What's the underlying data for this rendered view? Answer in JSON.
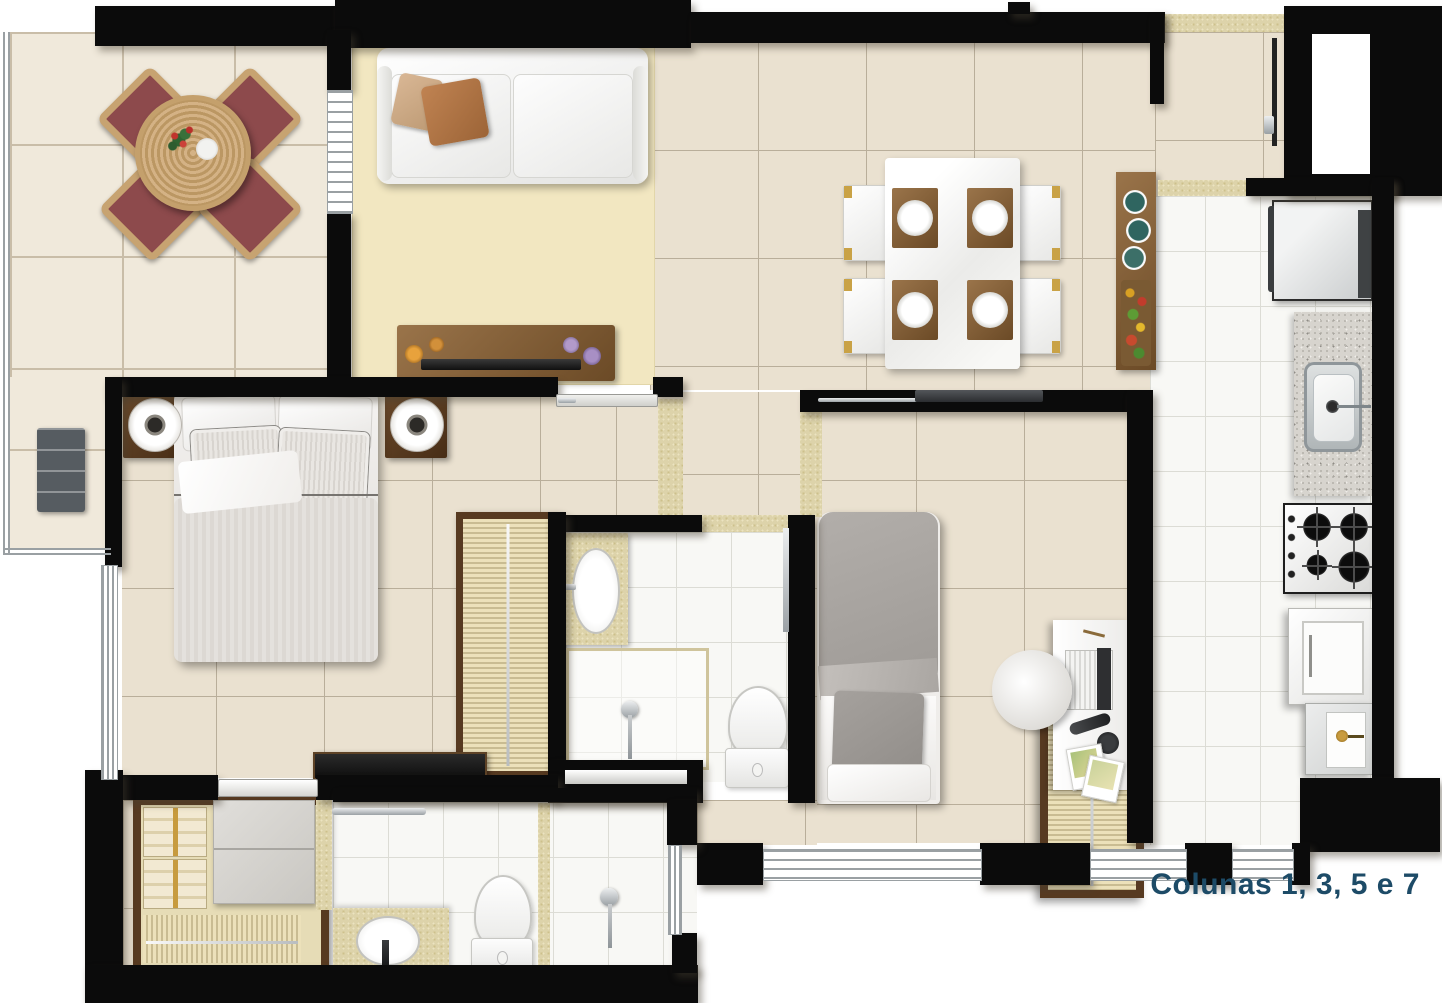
{
  "caption": {
    "text": "Colunas 1, 3, 5 e 7"
  },
  "palette": {
    "wall": "#0b0b0b",
    "caption": "#1d4b67",
    "tile-beige": "#eae1d0",
    "grout-beige": "#b9ae9a",
    "tile-white": "#f8f8f5",
    "grout-white": "#dcdcd5",
    "marble": "#f0e9db",
    "grout-marble": "#c9bda8",
    "carpet": "#f2e7c1",
    "travertine": "#ddd3aa",
    "wood": "#8a6840",
    "wood-dark": "#573a21",
    "rattan": "#c7a371",
    "cushion": "#8d4a4c",
    "chrome": "#aeb4b8",
    "granite": "#d7d4ce",
    "gray-furniture": "#d8d6d1",
    "blanket-gray": "#a8a4a0",
    "teal-bowl": "#2f6560"
  }
}
